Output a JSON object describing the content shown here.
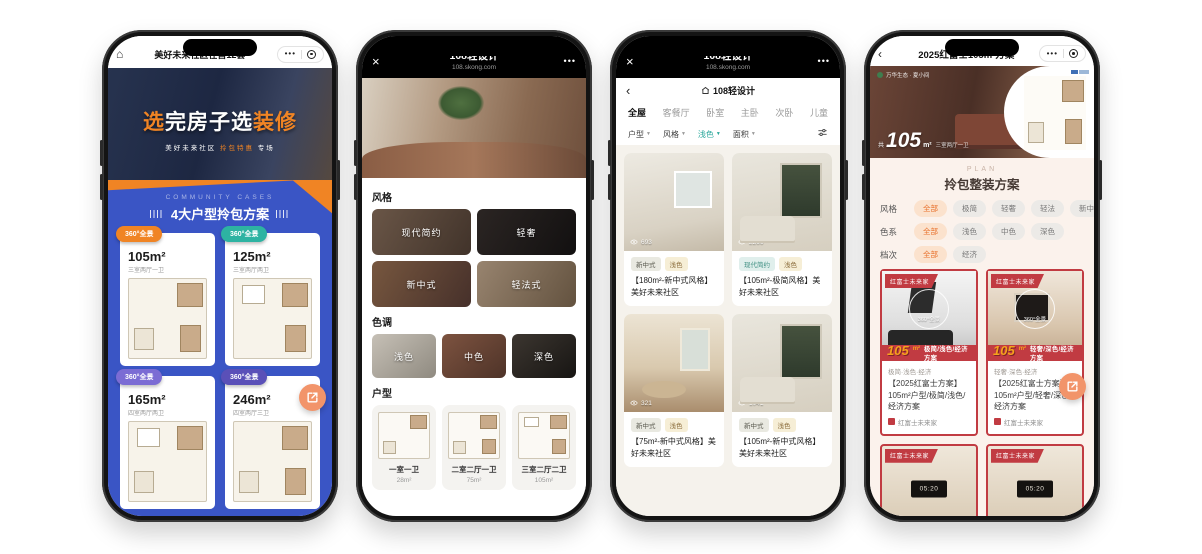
{
  "colors": {
    "phone1_blue": "#3a55c5",
    "phone1_orange": "#f08424",
    "phone3_accent": "#2aa79b",
    "phone4_red": "#c13b42",
    "phone4_orange": "#f6a21c"
  },
  "phone1": {
    "nav": {
      "title": "美好未来社区在售12套",
      "menu_dots": "•••"
    },
    "hero": {
      "title_pre": "选",
      "title_mid": "完房子选",
      "title_suf": "装修",
      "sub_pre": "美好未来社区 ",
      "sub_hl": "拎包特惠",
      "sub_suf": " 专场"
    },
    "cases": {
      "eyebrow": "COMMUNITY CASES",
      "title": "4大户型拎包方案",
      "cards": [
        {
          "badge": "360°全景",
          "color": "#f08424",
          "area": "105m²",
          "rooms": "三室两厅一卫"
        },
        {
          "badge": "360°全景",
          "color": "#2db3a2",
          "area": "125m²",
          "rooms": "三室两厅两卫"
        },
        {
          "badge": "360°全景",
          "color": "#7b6cd4",
          "area": "165m²",
          "rooms": "四室两厅两卫"
        },
        {
          "badge": "360°全景",
          "color": "#5a50b8",
          "area": "246m²",
          "rooms": "四室两厅三卫"
        }
      ]
    }
  },
  "phone2": {
    "nav": {
      "close": "×",
      "title": "108轻设计",
      "domain": "108.skong.com",
      "menu_dots": "•••"
    },
    "style": {
      "heading": "风格",
      "items": [
        "现代简约",
        "轻奢",
        "新中式",
        "轻法式"
      ]
    },
    "tone": {
      "heading": "色调",
      "items": [
        "浅色",
        "中色",
        "深色"
      ]
    },
    "layout": {
      "heading": "户型",
      "items": [
        {
          "name": "一室一卫",
          "area": "28m²"
        },
        {
          "name": "二室二厅一卫",
          "area": "75m²"
        },
        {
          "name": "三室二厅二卫",
          "area": "105m²"
        }
      ]
    }
  },
  "phone3": {
    "nav": {
      "close": "×",
      "title": "108轻设计",
      "domain": "108.skong.com",
      "menu_dots": "•••"
    },
    "subheader": {
      "back": "‹",
      "title": "108轻设计"
    },
    "tabs": [
      "全屋",
      "客餐厅",
      "卧室",
      "主卧",
      "次卧",
      "儿童"
    ],
    "filters": [
      "户型",
      "风格",
      "浅色",
      "面积"
    ],
    "cards": [
      {
        "views": "693",
        "tag1": "新中式",
        "tag2": "浅色",
        "title": "【180m²-新中式风格】美好未来社区"
      },
      {
        "views": "2266",
        "tag1": "现代简约",
        "tag2": "浅色",
        "title": "【105m²-极简风格】美好未来社区"
      },
      {
        "views": "321",
        "tag1": "新中式",
        "tag2": "浅色",
        "title": "【75m²-新中式风格】美好未来社区"
      },
      {
        "views": "1041",
        "tag1": "新中式",
        "tag2": "浅色",
        "title": "【105m²-新中式风格】美好未来社区"
      }
    ]
  },
  "phone4": {
    "nav": {
      "back": "‹",
      "title": "2025红富士105m²方案",
      "menu_dots": "•••"
    },
    "hero": {
      "brand": "万华生态 · 夏小间",
      "area_prefix": "共",
      "area": "105",
      "area_unit": "m²",
      "rooms": "三室两厅一卫"
    },
    "plan": {
      "eyebrow": "PLAN",
      "title": "拎包整装方案"
    },
    "filters": [
      {
        "label": "风格",
        "options": [
          "全部",
          "极简",
          "轻奢",
          "轻法",
          "新中"
        ]
      },
      {
        "label": "色系",
        "options": [
          "全部",
          "浅色",
          "中色",
          "深色"
        ]
      },
      {
        "label": "档次",
        "options": [
          "全部",
          "经济"
        ]
      }
    ],
    "cards": [
      {
        "ribbon": "红富士未来家",
        "watermark": "360°全景",
        "area": "105",
        "area_unit": "m²",
        "banner": "极简/浅色/经济方案",
        "meta": "极简·浅色·经济",
        "title": "【2025红富士方案】105m²户型/极简/浅色/经济方案",
        "source": "红富士未来家"
      },
      {
        "ribbon": "红富士未来家",
        "watermark": "360°全景",
        "area": "105",
        "area_unit": "m²",
        "banner": "轻奢/深色/经济方案",
        "meta": "轻奢·深色·经济",
        "title": "【2025红富士方案】105m²户型/轻奢/深色/经济方案",
        "source": "红富士未来家"
      }
    ],
    "bottom_cards": [
      {
        "ribbon": "红富士未来家",
        "clock": "05:20"
      },
      {
        "ribbon": "红富士未来家",
        "clock": "05:20"
      }
    ]
  }
}
